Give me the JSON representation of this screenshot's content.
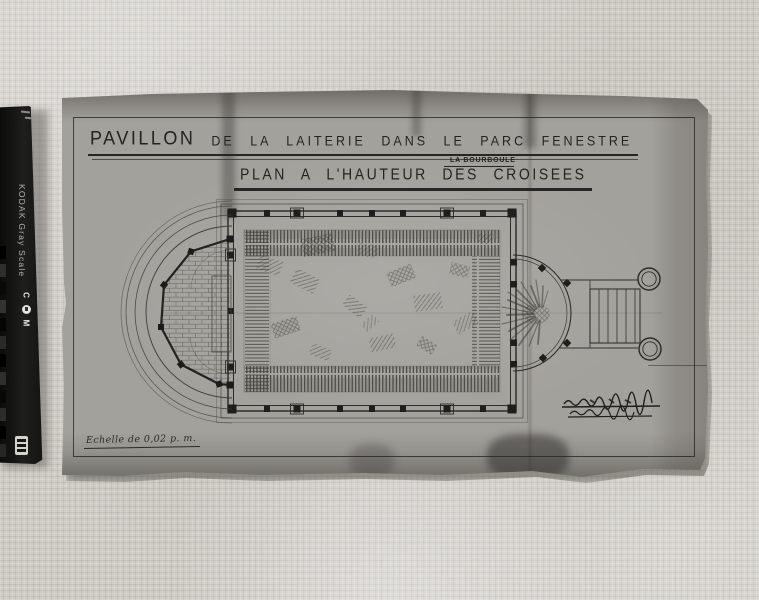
{
  "scene": {
    "fabric_color": "#cfccc6",
    "paper_color": "#a3a19c",
    "ink_color": "#232321"
  },
  "gray_scale_ruler": {
    "label": "KODAK Gray Scale",
    "markings": [
      "C",
      "Y",
      "M"
    ]
  },
  "title_block": {
    "main_title_emphasis": "PAVILLON",
    "main_title_rest": "DE LA LAITERIE DANS LE PARC FENESTRE",
    "location": "LA BOURBOULE",
    "subtitle": "PLAN A L'HAUTEUR DES CROISEES"
  },
  "annotations": {
    "scale_note": "Echelle de 0,02 p. m."
  }
}
